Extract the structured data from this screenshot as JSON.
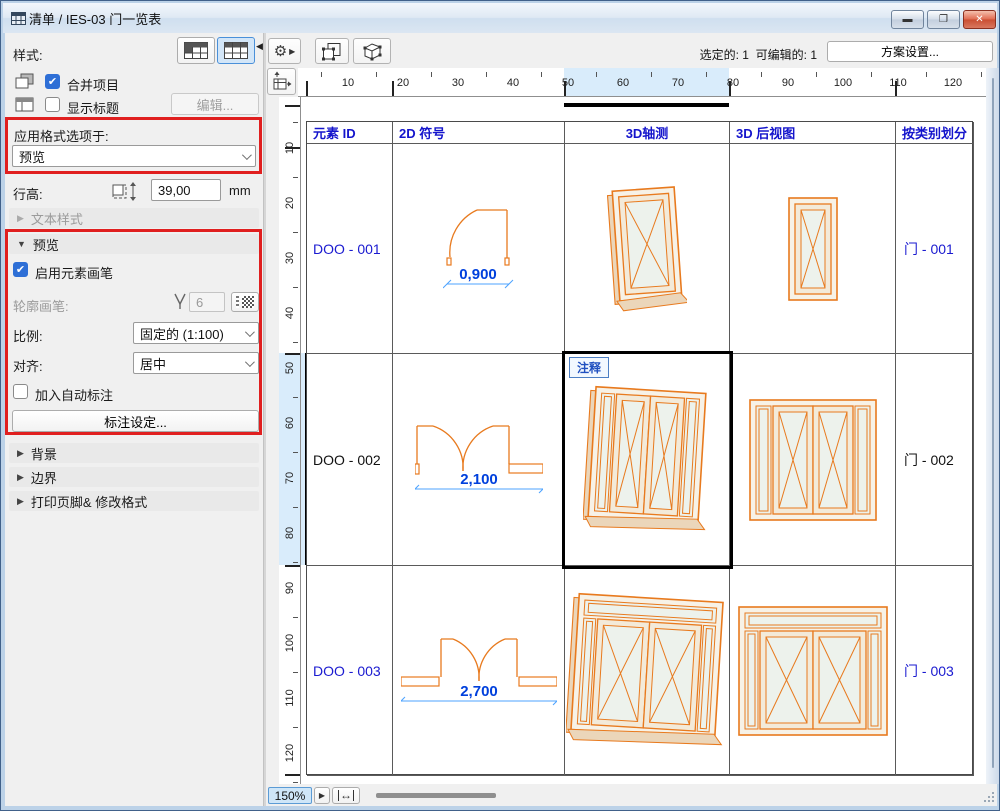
{
  "window": {
    "title": "清单 / IES-03 门一览表"
  },
  "left_panel": {
    "style_label": "样式:",
    "merge_items_label": "合并项目",
    "show_title_label": "显示标题",
    "edit_button": "编辑...",
    "apply_format_label": "应用格式选项于:",
    "apply_format_value": "预览",
    "row_height_label": "行高:",
    "row_height_value": "39,00",
    "row_height_unit": "mm",
    "text_style_section": "文本样式",
    "preview_section": "预览",
    "enable_element_pen": "启用元素画笔",
    "outline_pen_label": "轮廓画笔:",
    "outline_pen_value": "6",
    "scale_label": "比例:",
    "scale_value": "固定的 (1:100)",
    "align_label": "对齐:",
    "align_value": "居中",
    "auto_dimension_label": "加入自动标注",
    "dimension_settings_button": "标注设定...",
    "background_section": "背景",
    "border_section": "边界",
    "footer_section": "打印页脚& 修改格式"
  },
  "toolbar": {
    "selected_info": "选定的: 1",
    "editable_info": "可编辑的: 1",
    "scheme_settings_button": "方案设置..."
  },
  "ruler": {
    "h_numbers": [
      "10",
      "20",
      "30",
      "40",
      "50",
      "60",
      "70",
      "80",
      "90",
      "100",
      "110",
      "120"
    ],
    "v_numbers": [
      "10",
      "20",
      "30",
      "40",
      "50",
      "60",
      "70",
      "80",
      "90",
      "100",
      "110",
      "120"
    ]
  },
  "table": {
    "headers": [
      "元素 ID",
      "2D 符号",
      "3D轴测",
      "3D 后视图",
      "按类别划分"
    ],
    "rows": [
      {
        "id": "DOO - 001",
        "dimension": "0,900",
        "category": "门 - 001",
        "selected": false,
        "symbol": "single-swing",
        "note": ""
      },
      {
        "id": "DOO - 002",
        "dimension": "2,100",
        "category": "门 - 002",
        "selected": true,
        "symbol": "double-swing-side-panel",
        "note": "注释"
      },
      {
        "id": "DOO - 003",
        "dimension": "2,700",
        "category": "门 - 003",
        "selected": false,
        "symbol": "double-swing-two-panels",
        "note": ""
      }
    ]
  },
  "statusbar": {
    "zoom_value": "150%"
  },
  "colors": {
    "door_orange": "#e87a1e",
    "dim_text_blue": "#0040dd",
    "dim_line_blue": "#4da3ff",
    "id_text_blue": "#1a1ad0",
    "highlight_blue": "#d9ecfb",
    "annotation_red": "#e01f1f"
  }
}
